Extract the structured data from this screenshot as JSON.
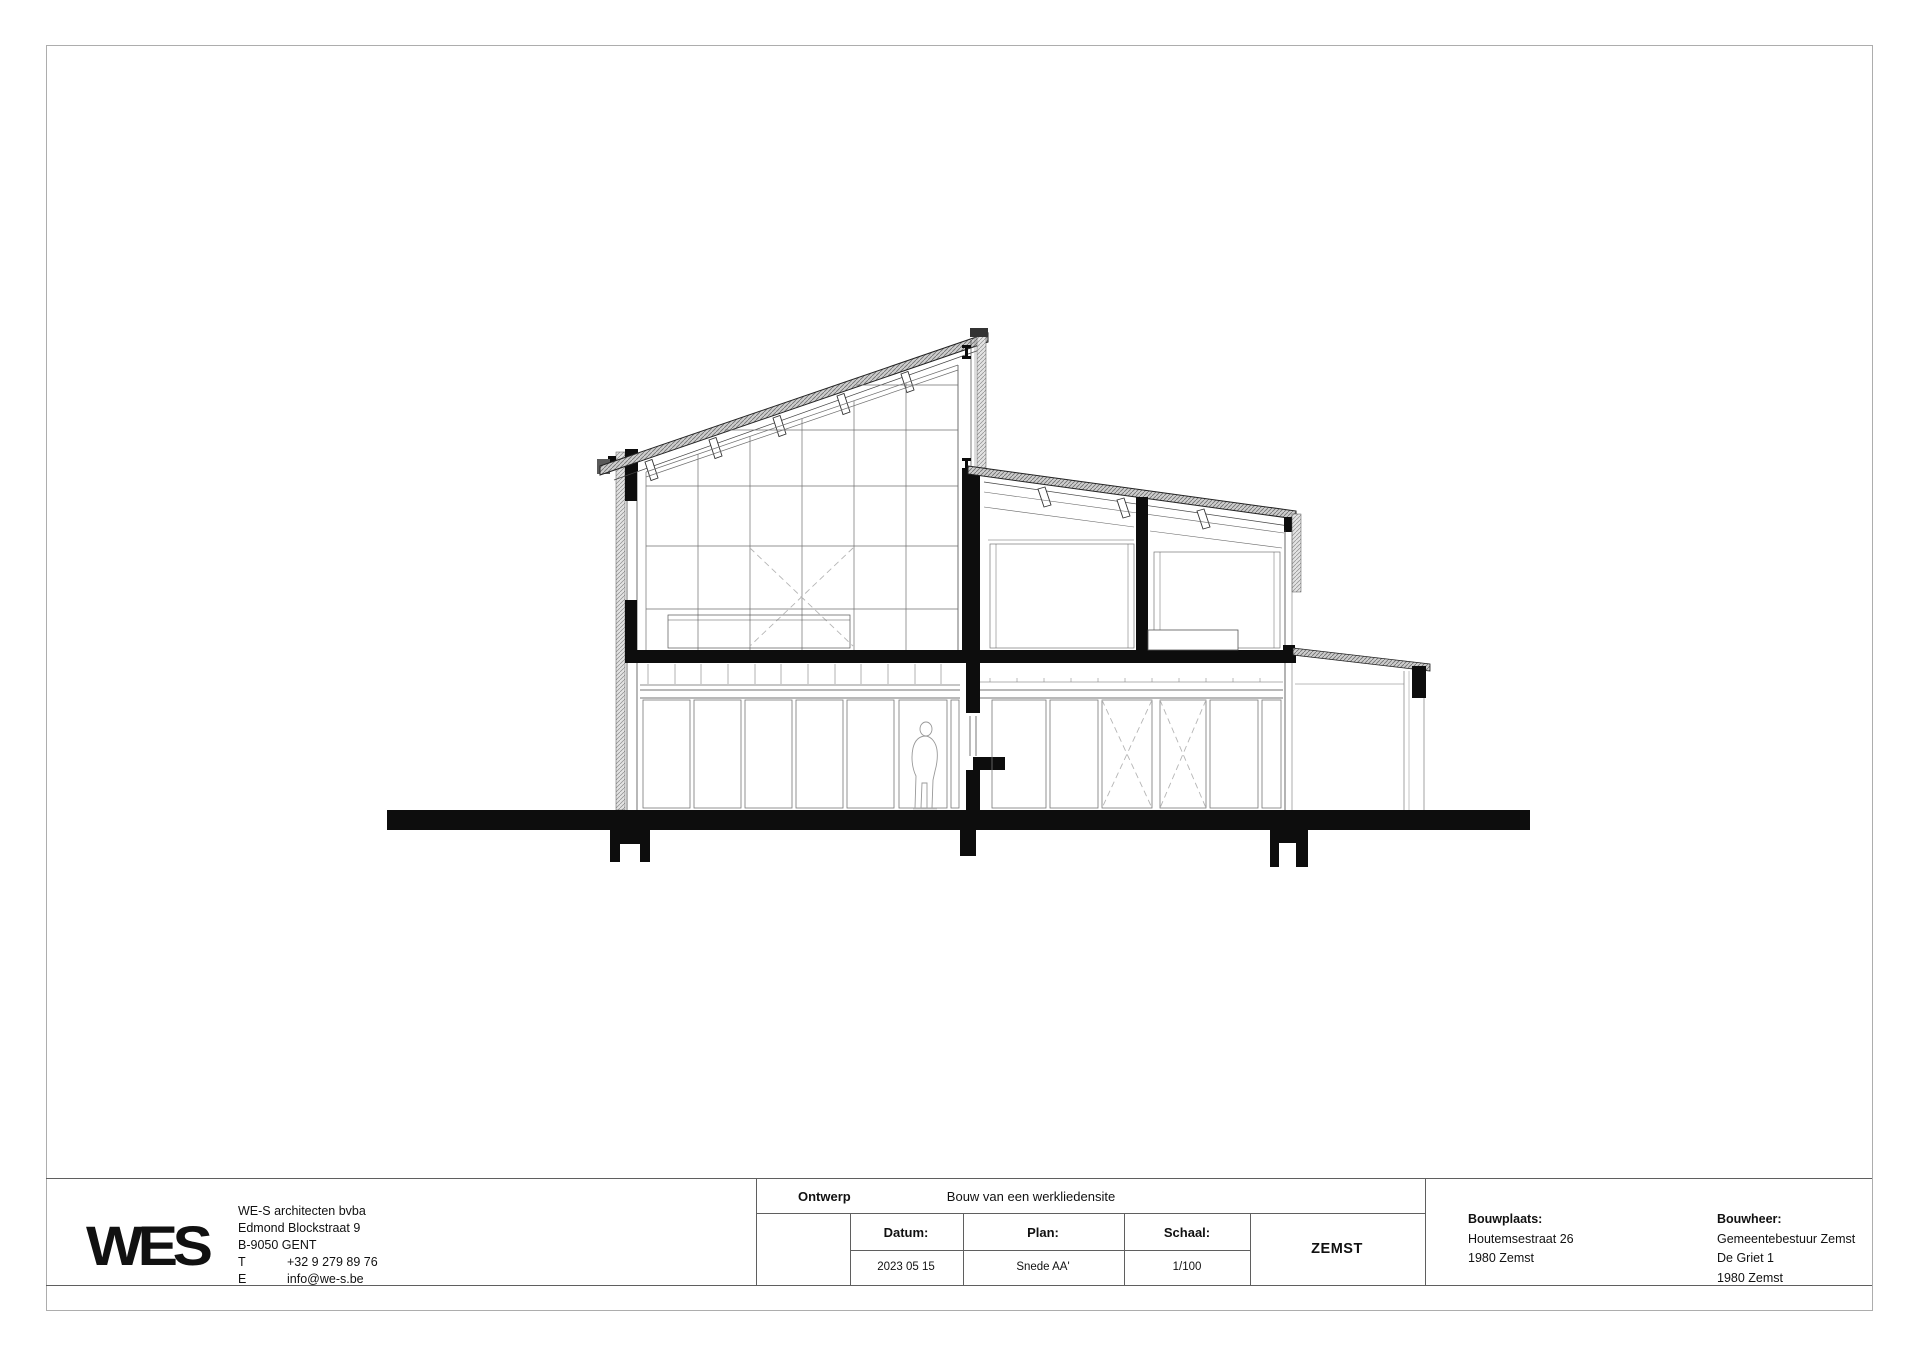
{
  "titleblock": {
    "logo_text": "WES",
    "firm": {
      "name": "WE-S architecten bvba",
      "street": "Edmond Blockstraat 9",
      "city": "B-9050 GENT",
      "phone_label": "T",
      "phone": "+32 9 279 89 76",
      "email_label": "E",
      "email": "info@we-s.be"
    },
    "ontwerp": {
      "label": "Ontwerp",
      "value": "Bouw van een werkliedensite"
    },
    "datum": {
      "label": "Datum:",
      "value": "2023 05 15"
    },
    "plan": {
      "label": "Plan:",
      "value": "Snede AA'"
    },
    "schaal": {
      "label": "Schaal:",
      "value": "1/100"
    },
    "gemeente": "ZEMST",
    "bouwplaats": {
      "label": "Bouwplaats:",
      "line1": "Houtemsestraat 26",
      "line2": "1980 Zemst"
    },
    "bouwheer": {
      "label": "Bouwheer:",
      "line1": "Gemeentebestuur Zemst",
      "line2": "De Griet 1",
      "line3": "1980 Zemst"
    }
  },
  "colors": {
    "ink": "#111111",
    "section_black": "#0d0d0d",
    "line_gray": "#555555",
    "glazing_gray": "#777777",
    "dashed_brace": "#b5b5b5",
    "figure_outline": "#999999",
    "page_border": "#adadad"
  }
}
